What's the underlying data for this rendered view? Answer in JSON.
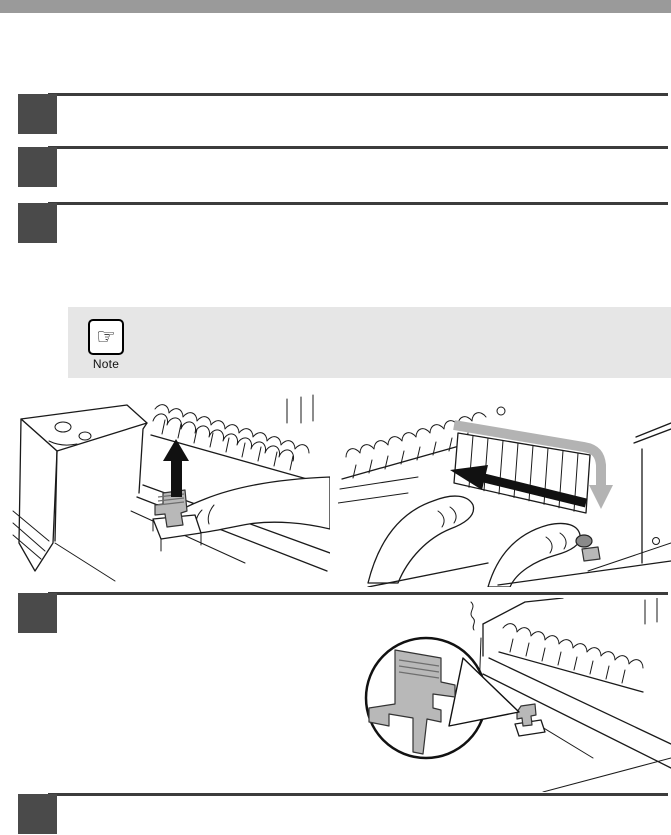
{
  "page": {
    "background": "#ffffff",
    "top_bar_color": "#9a9a9a",
    "step_marker_color": "#4a4a4a",
    "rule_color": "#3c3c3c"
  },
  "note": {
    "label": "Note",
    "icon": "pointing-hand-icon",
    "icon_glyph": "☞",
    "box_background": "#e6e6e6"
  },
  "steps": [
    {
      "name": "step-marker-1"
    },
    {
      "name": "step-marker-2"
    },
    {
      "name": "step-marker-3"
    },
    {
      "name": "step-marker-4"
    },
    {
      "name": "step-marker-5"
    }
  ],
  "figures": [
    {
      "name": "figure-push-release-lever-up"
    },
    {
      "name": "figure-remove-paper-guide"
    },
    {
      "name": "figure-release-lever-detail"
    }
  ]
}
